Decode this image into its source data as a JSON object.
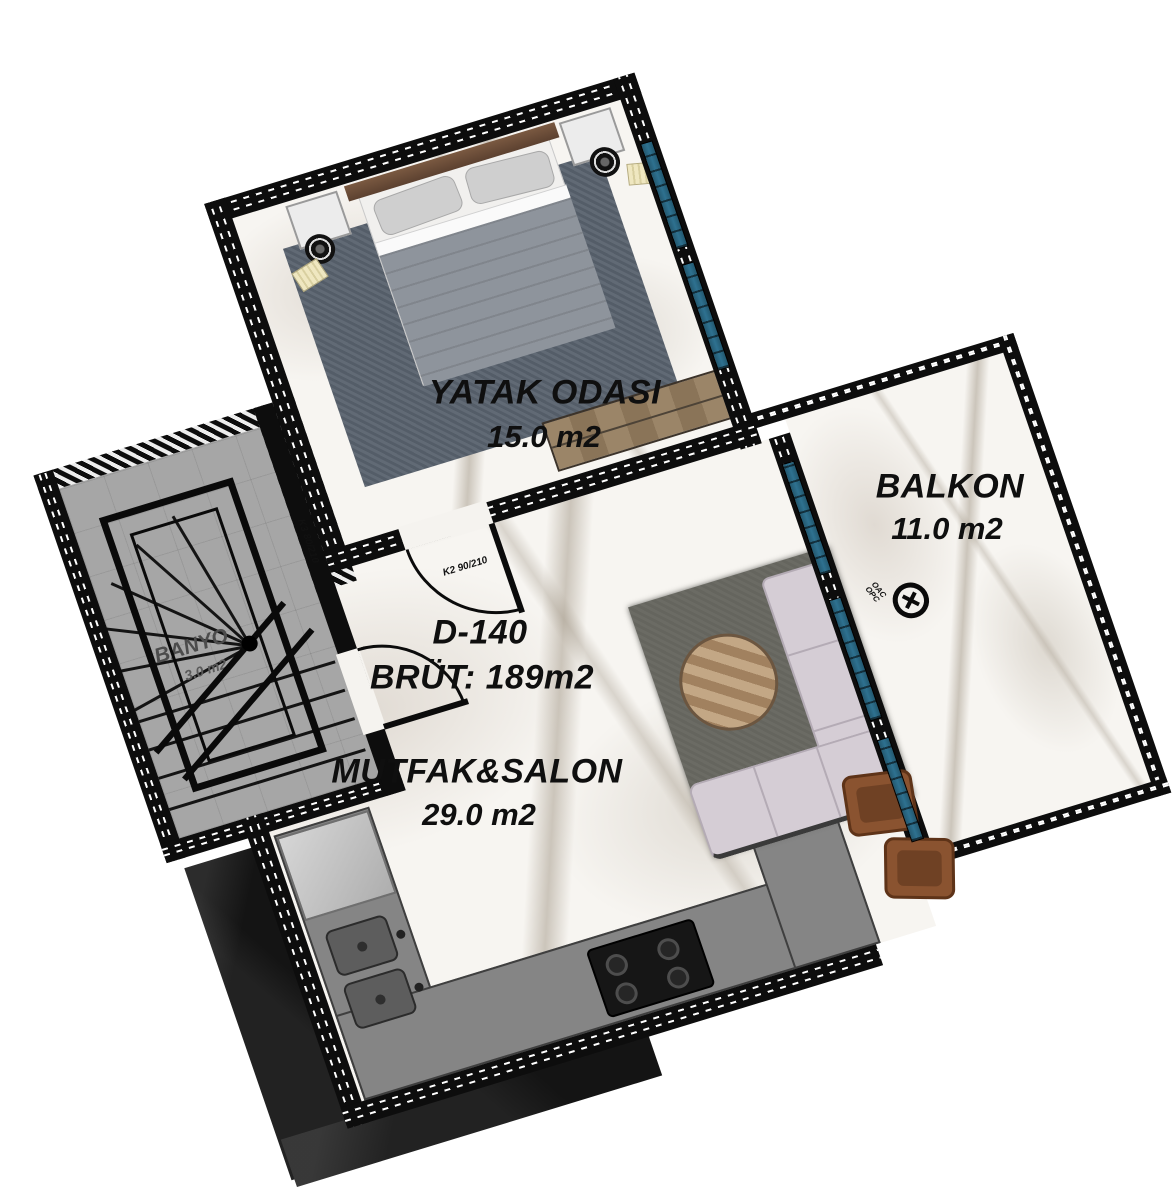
{
  "plan": {
    "unit": {
      "code": "D-140",
      "gross": "BRÜT: 189m2"
    },
    "rooms": [
      {
        "id": "bedroom",
        "name": "YATAK ODASI",
        "area": "15.0 m2"
      },
      {
        "id": "kitchen_salon",
        "name": "MUTFAK&SALON",
        "area": "29.0 m2"
      },
      {
        "id": "balcony",
        "name": "BALKON",
        "area": "11.0 m2"
      },
      {
        "id": "bathroom",
        "name": "BANYO",
        "area": "3.0 m2"
      }
    ],
    "doors": [
      {
        "id": "bedroom-door",
        "label": "K2 90/210"
      },
      {
        "id": "stair-door",
        "label": "K3 80/210"
      }
    ],
    "equipment": [
      {
        "id": "ac-unit",
        "labels": [
          "OAC",
          "OPC"
        ]
      }
    ],
    "colors": {
      "wall": "#0d0d0d",
      "window_glass": "#2e7190",
      "floor_marble": "#f7f5f1",
      "counter": "#858585",
      "rug_living": "#6b6b64",
      "rug_bedroom": "#59626e",
      "sofa": "#d5cdd5",
      "wood": "#97815f",
      "armchair": "#8a5330",
      "duvet": "#8e949c"
    }
  }
}
